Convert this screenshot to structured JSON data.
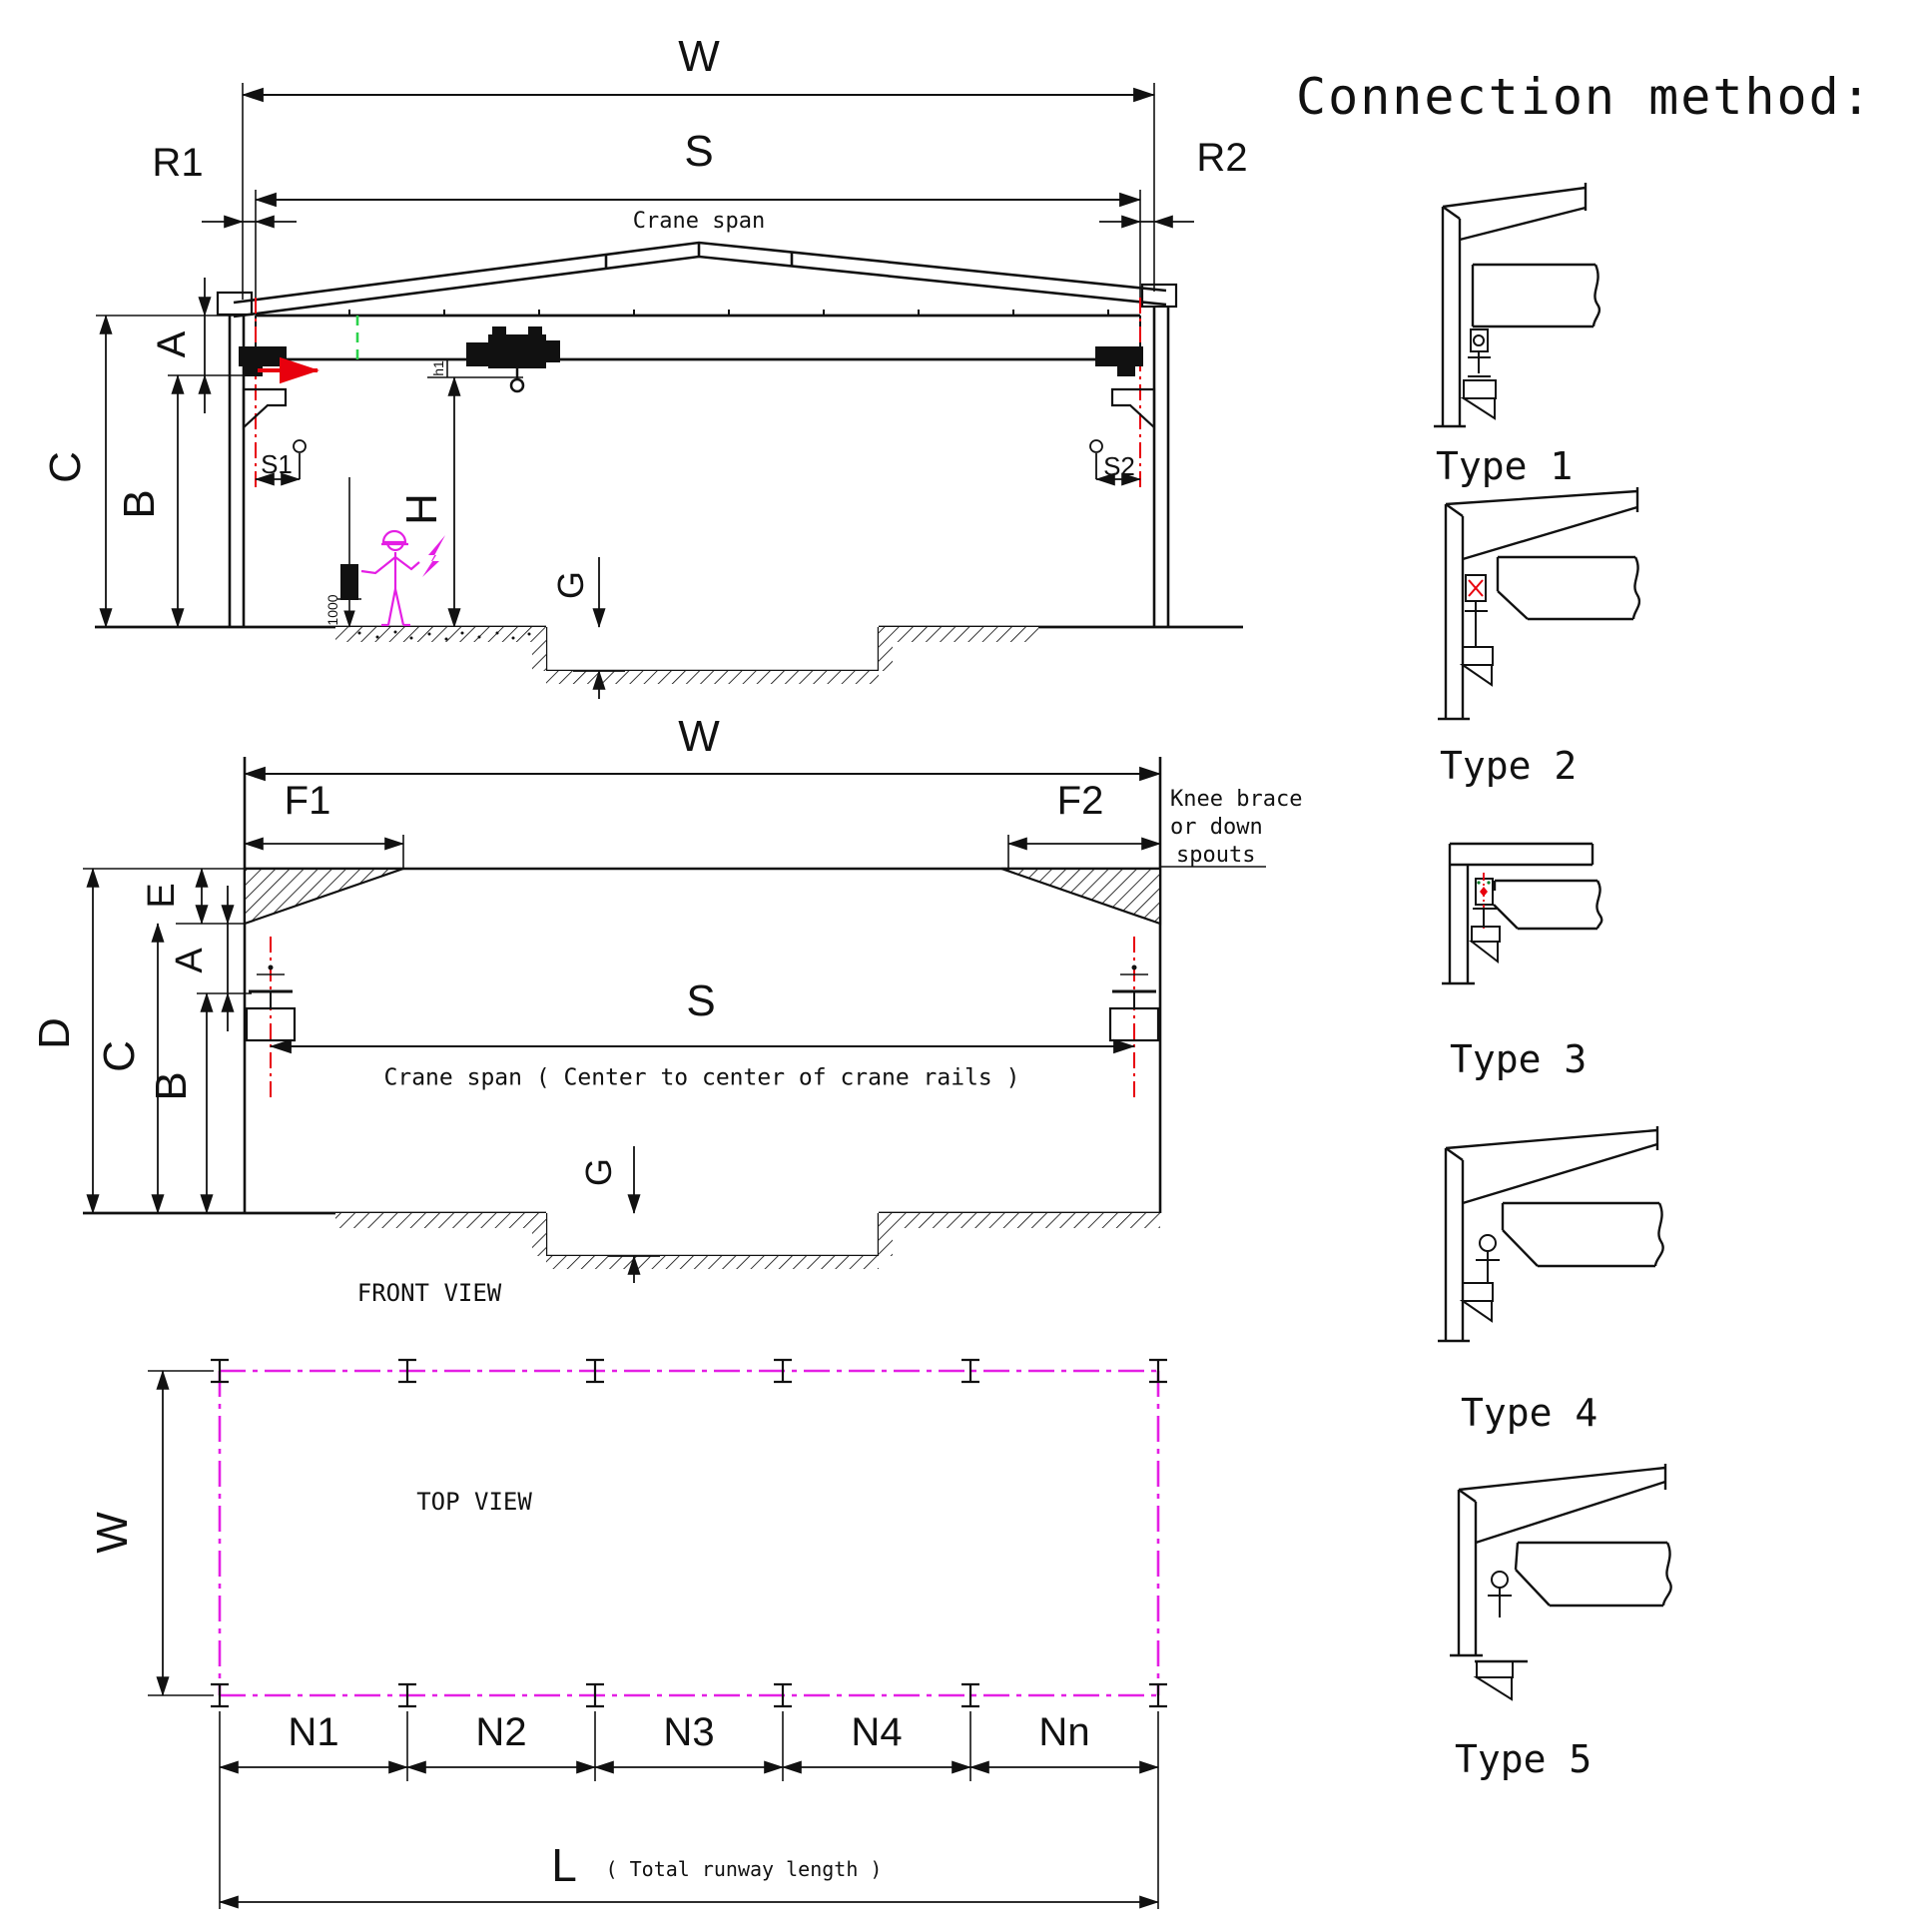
{
  "colors": {
    "line": "#111111",
    "red": "#e8000d",
    "green": "#2ad24b",
    "magenta": "#e41fe4"
  },
  "cross_section_view": {
    "dim_w": "W",
    "dim_s": "S",
    "crane_span_note": "Crane span",
    "dim_r1": "R1",
    "dim_r2": "R2",
    "dim_a": "A",
    "dim_b": "B",
    "dim_c": "C",
    "dim_h": "H",
    "dim_g": "G",
    "dim_s1": "S1",
    "dim_s2": "S2",
    "dim_h1": "h1",
    "pendant_height": "1000"
  },
  "front_view": {
    "title": "FRONT VIEW",
    "dim_w": "W",
    "dim_f1": "F1",
    "dim_f2": "F2",
    "dim_e": "E",
    "dim_a": "A",
    "dim_b": "B",
    "dim_c": "C",
    "dim_d": "D",
    "dim_g": "G",
    "dim_s": "S",
    "crane_span_note": "Crane span  ( Center to center of crane rails )",
    "knee_note_line1": "Knee brace",
    "knee_note_line2": "or down",
    "knee_note_line3": "spouts"
  },
  "top_view": {
    "title": "TOP VIEW",
    "dim_w": "W",
    "bays": [
      "N1",
      "N2",
      "N3",
      "N4",
      "Nn"
    ],
    "dim_l": "L",
    "l_note": "( Total runway length )"
  },
  "connection_methods": {
    "title": "Connection method:",
    "types": [
      "Type 1",
      "Type 2",
      "Type 3",
      "Type 4",
      "Type 5"
    ]
  }
}
